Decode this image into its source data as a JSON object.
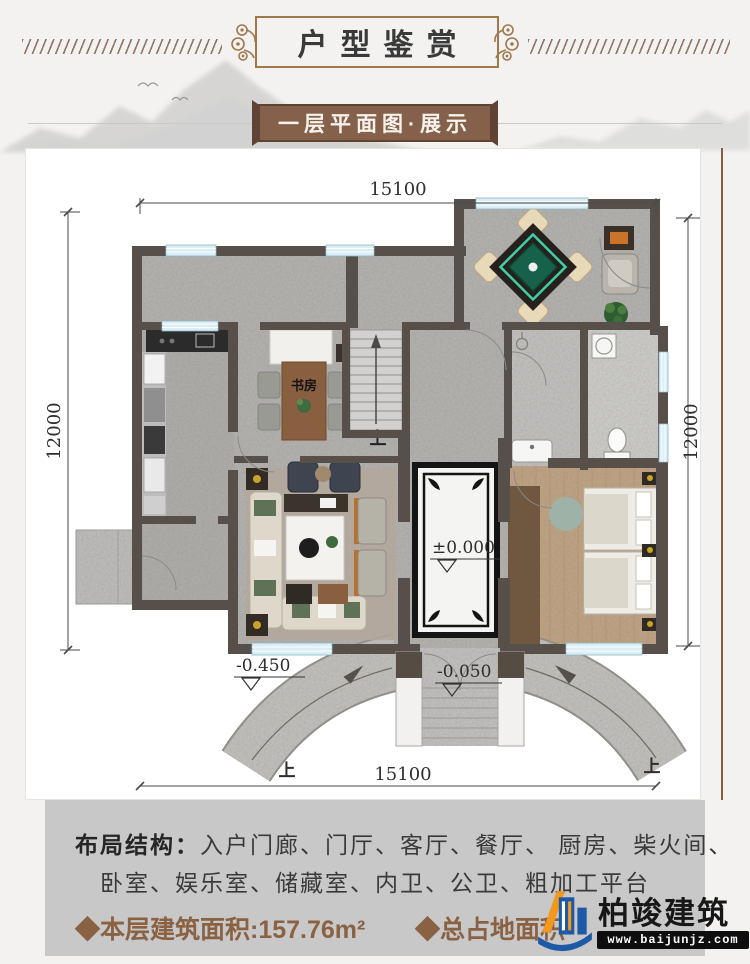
{
  "header": {
    "title": "户型鉴赏"
  },
  "subtitle": {
    "label": "一层平面图·展示"
  },
  "plan": {
    "dim_top": "15100",
    "dim_bottom": "15100",
    "dim_left": "12000",
    "dim_right": "12000",
    "study_label": "书房",
    "level_zero": "±0.000",
    "level_ramp": "-0.450",
    "level_porch": "-0.050",
    "up_stairs": "上",
    "up_ramp_left": "上",
    "up_ramp_right": "上"
  },
  "info": {
    "layout_label": "布局结构：",
    "layout_line1": "入户门廊、门厅、客厅、餐厅、 厨房、柴火间、",
    "layout_line2": "卧室、娱乐室、储藏室、内卫、公卫、粗加工平台",
    "floor_area": "◆本层建筑面积:157.76m²",
    "total_area": "◆总占地面积"
  },
  "logo": {
    "name": "柏竣建筑",
    "website": "www.baijunjz.com"
  },
  "colors": {
    "banner_brown": "#a0784e",
    "subtitle_bg": "#85604a",
    "wall": "#57504a",
    "window_blue": "#d9eef5",
    "mahjong_green": "#17604a",
    "area_text": "#8a6243",
    "logo_blue": "#1d59a5",
    "logo_orange": "#f2981d"
  }
}
